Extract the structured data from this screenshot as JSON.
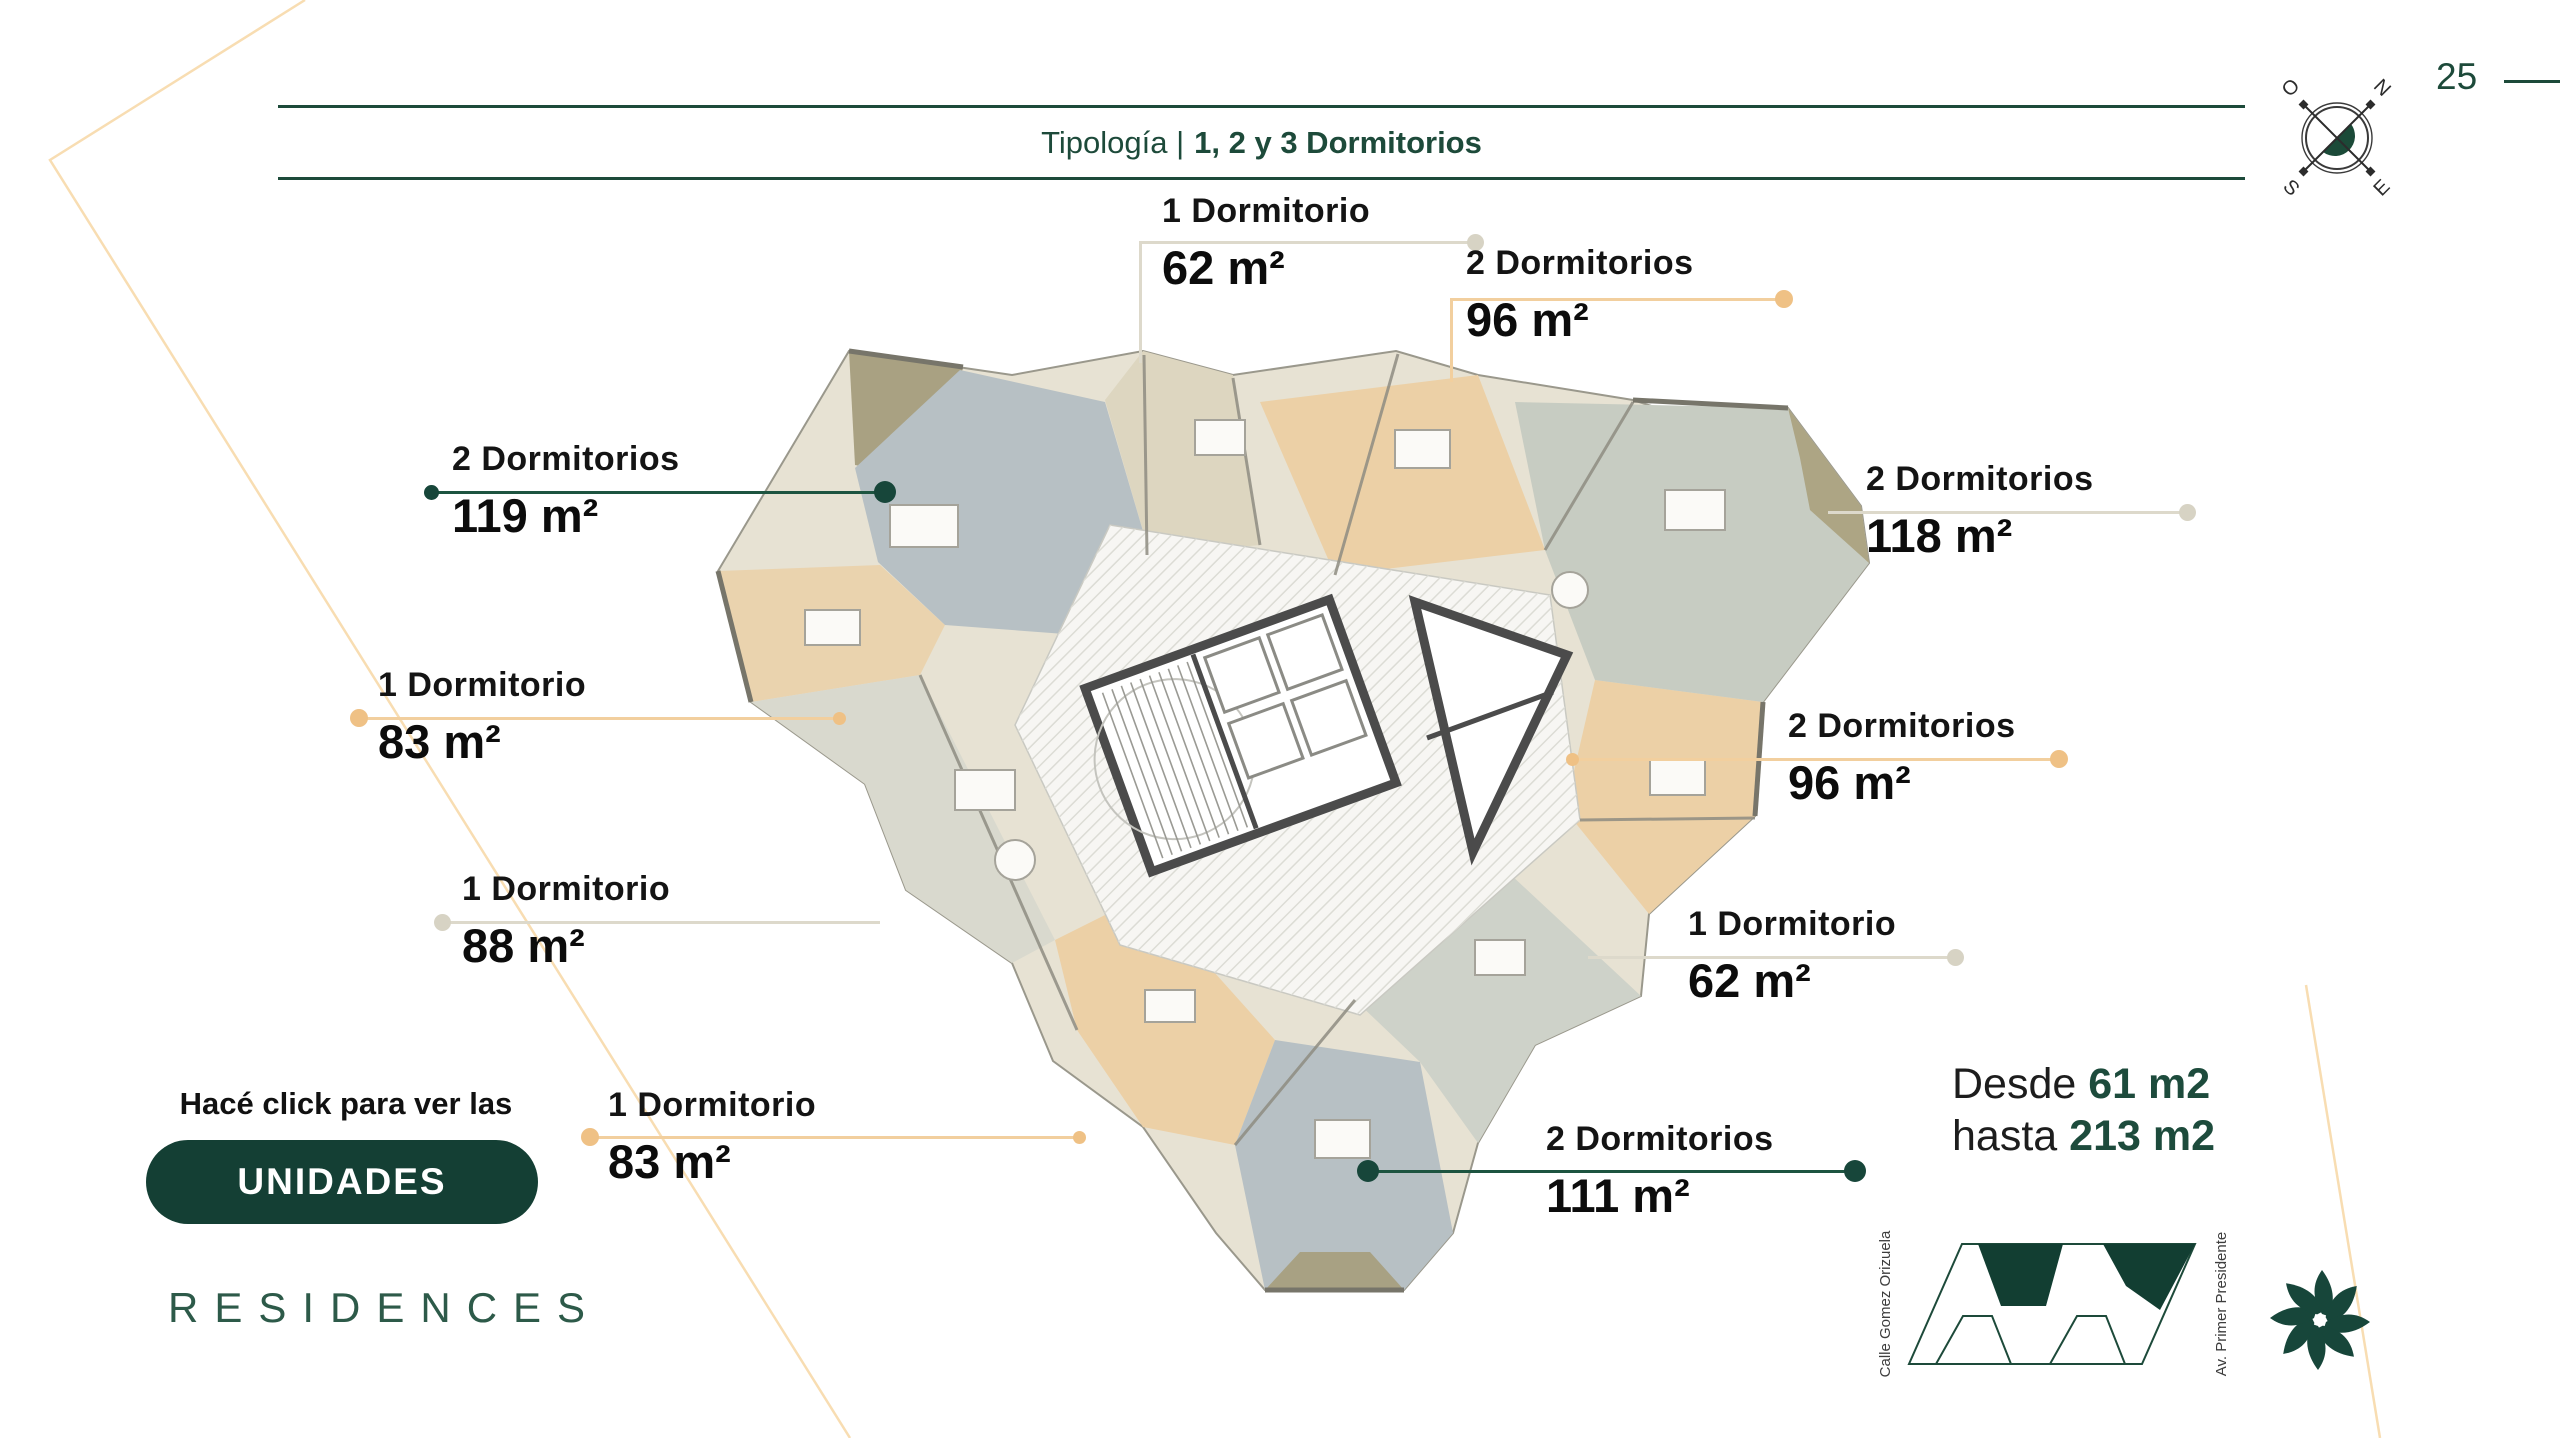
{
  "page": {
    "number": "25"
  },
  "header": {
    "title_regular": "Tipología |",
    "title_bold": "1, 2 y 3 Dormitorios"
  },
  "units": [
    {
      "type": "1 Dormitorio",
      "area": "62 m²"
    },
    {
      "type": "2 Dormitorios",
      "area": "96 m²"
    },
    {
      "type": "2 Dormitorios",
      "area": "119 m²"
    },
    {
      "type": "2 Dormitorios",
      "area": "118 m²"
    },
    {
      "type": "1 Dormitorio",
      "area": "83 m²"
    },
    {
      "type": "2 Dormitorios",
      "area": "96 m²"
    },
    {
      "type": "1 Dormitorio",
      "area": "88 m²"
    },
    {
      "type": "1 Dormitorio",
      "area": "62 m²"
    },
    {
      "type": "1 Dormitorio",
      "area": "83 m²"
    },
    {
      "type": "2 Dormitorios",
      "area": "111 m²"
    }
  ],
  "range": {
    "desde_label": "Desde",
    "desde_value": "61 m2",
    "hasta_label": "hasta",
    "hasta_value": "213 m2"
  },
  "cta": {
    "hint": "Hacé click para ver las",
    "button_label": "UNIDADES"
  },
  "brand": {
    "residences": "RESIDENCES"
  },
  "compass": {
    "n": "N",
    "e": "E",
    "s": "S",
    "o": "O"
  },
  "siteplan": {
    "street_left": "Calle Gomez Orizuela",
    "street_right": "Av. Primer Presidente"
  },
  "colors": {
    "dark_green": "#17463a",
    "green_text": "#1d4a3a",
    "gold": "#efc185",
    "gold_line": "#f2cf9e",
    "gray_line": "#ddd9cb",
    "peach_deco": "#f8ddb2",
    "plan_peach": "#ecd0a6",
    "plan_bluegray": "#b7c0c4",
    "plan_olive": "#a9a182",
    "plan_gray": "#d9d9ce"
  }
}
